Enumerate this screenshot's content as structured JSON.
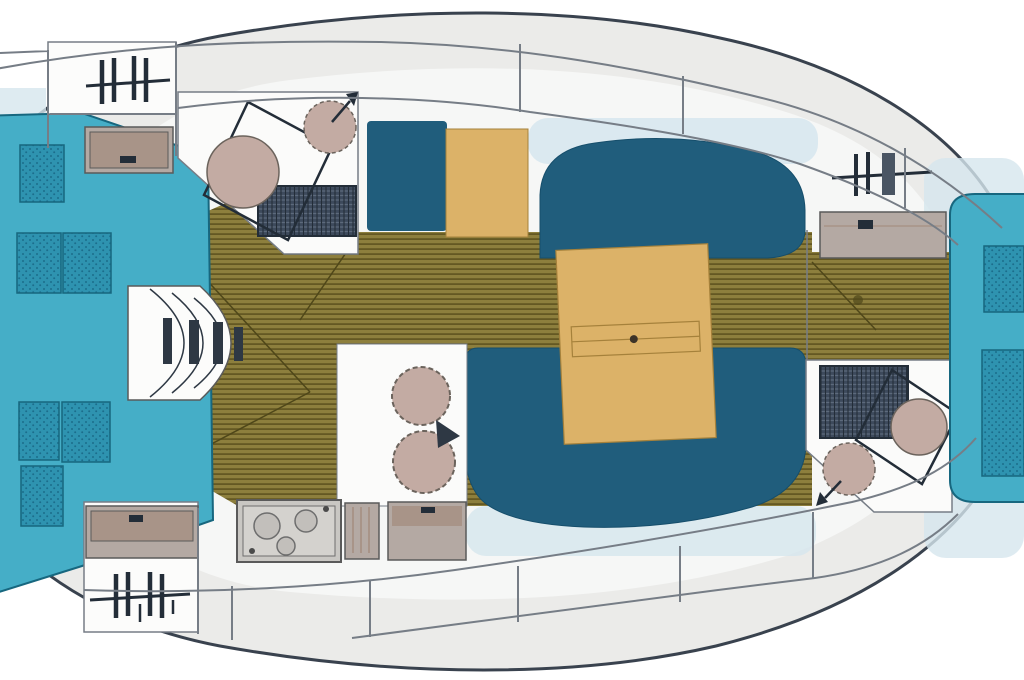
{
  "palette": {
    "pageBg": "#ffffff",
    "hullFill": "#ebebe9",
    "hullOutline": "#39424e",
    "cabinFill": "#f6f7f6",
    "deckLine": "#767d86",
    "panelWhite": "#fcfcfb",
    "floorBase": "#8d7f3d",
    "floorStripe": "#645823",
    "floorLine": "#4f4719",
    "berthTeal": "#45aec7",
    "berthTealDark": "#17677f",
    "pillowTeal": "#2e93b0",
    "pillowDot": "#1c6e8c",
    "navy": "#205d7c",
    "navyEdge": "#164e6b",
    "woodTan": "#dcb268",
    "tanEdge": "#a5813b",
    "grayFurniture": "#b4a9a3",
    "grayFurnitureEdge": "#5a5a5a",
    "innerPink": "#a89488",
    "fixture": "#c3aba3",
    "fixtureEdge": "#6b635c",
    "grateBg": "#3d4a5c",
    "grateLine": "#5d6a7c",
    "darkDetail": "#232d38",
    "barDark": "#2e3844",
    "paleBlue": "#d6e6ee",
    "headWhite": "#fbfbfa",
    "stoveFill": "#c9c7c3",
    "stoveInner": "#d4d2ce",
    "burnerFill": "#c2bfbb",
    "burnerEdge": "#6e6e6e",
    "knobDark": "#4a4a4a",
    "tableDot": "#3c3328",
    "hatchBarFill": "#4a5563"
  }
}
